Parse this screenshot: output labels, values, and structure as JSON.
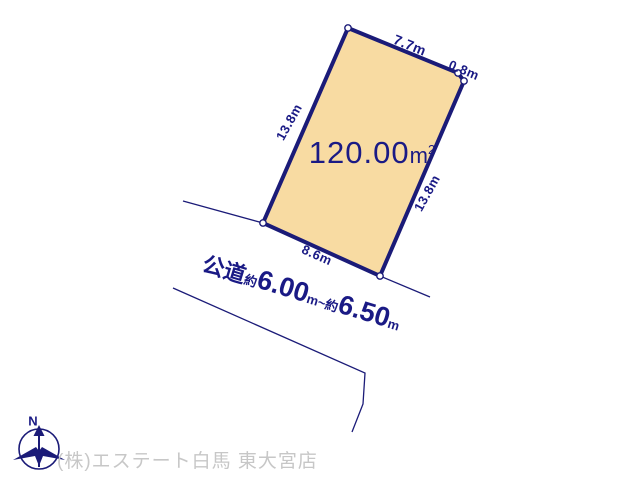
{
  "colors": {
    "parcel-fill": "#F8DBA2",
    "line-navy": "#1B1B78",
    "text-navy": "#1A1A85",
    "company-gray": "#C7C7C7"
  },
  "parcel": {
    "area_value": "120.00",
    "area_unit": "m",
    "area_sup": "2",
    "edges": {
      "top": "7.7m",
      "corner": "0.8m",
      "left": "13.8m",
      "right": "13.8m",
      "bottom": "8.6m"
    }
  },
  "road": {
    "label": "公道",
    "approx_prefix_1": "約",
    "width_1": "6.00",
    "unit_1": "m",
    "tilde": "~",
    "approx_prefix_2": "約",
    "width_2": "6.50",
    "unit_2": "m"
  },
  "compass": {
    "north_label": "N"
  },
  "footer": {
    "company": "(株)エステート白馬 東大宮店"
  }
}
